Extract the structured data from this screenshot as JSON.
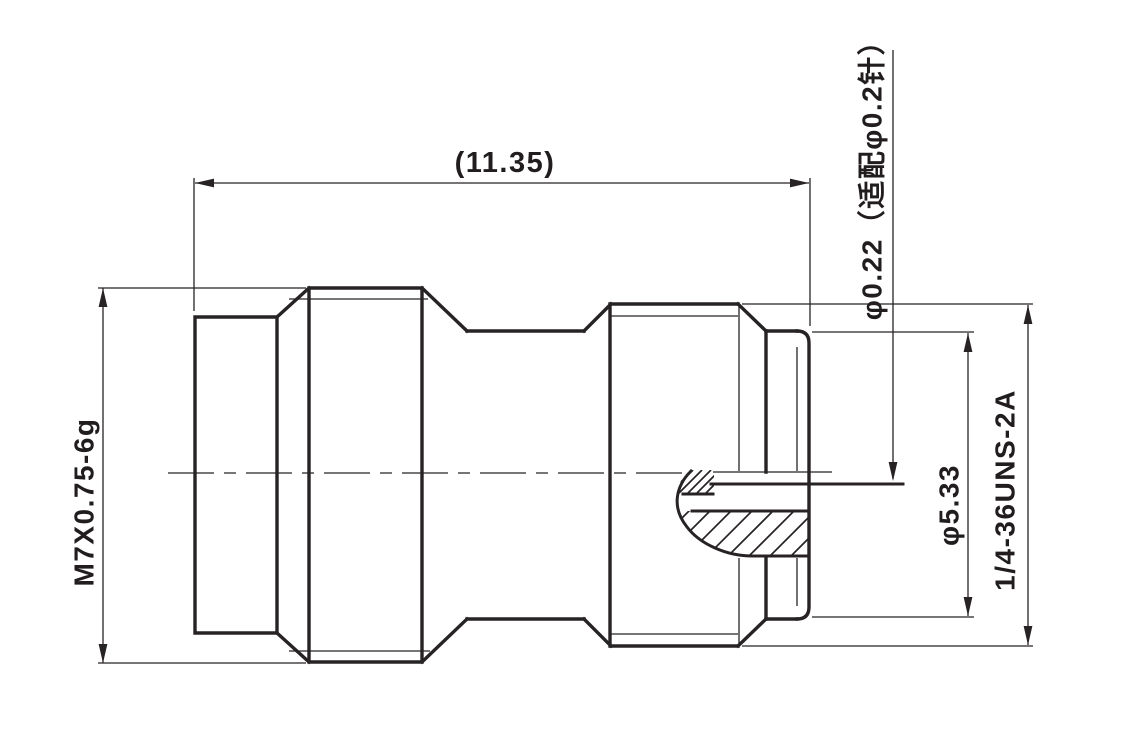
{
  "drawing": {
    "background_color": "#ffffff",
    "line_color": "#272325",
    "labels": {
      "overall_length": "(11.35)",
      "left_thread_spec": "M7X0.75-6g",
      "pin_diameter_note": "φ0.22（适配φ0.2针）",
      "interface_diameter": "φ5.33",
      "right_thread_spec": "1/4-36UNS-2A"
    }
  }
}
